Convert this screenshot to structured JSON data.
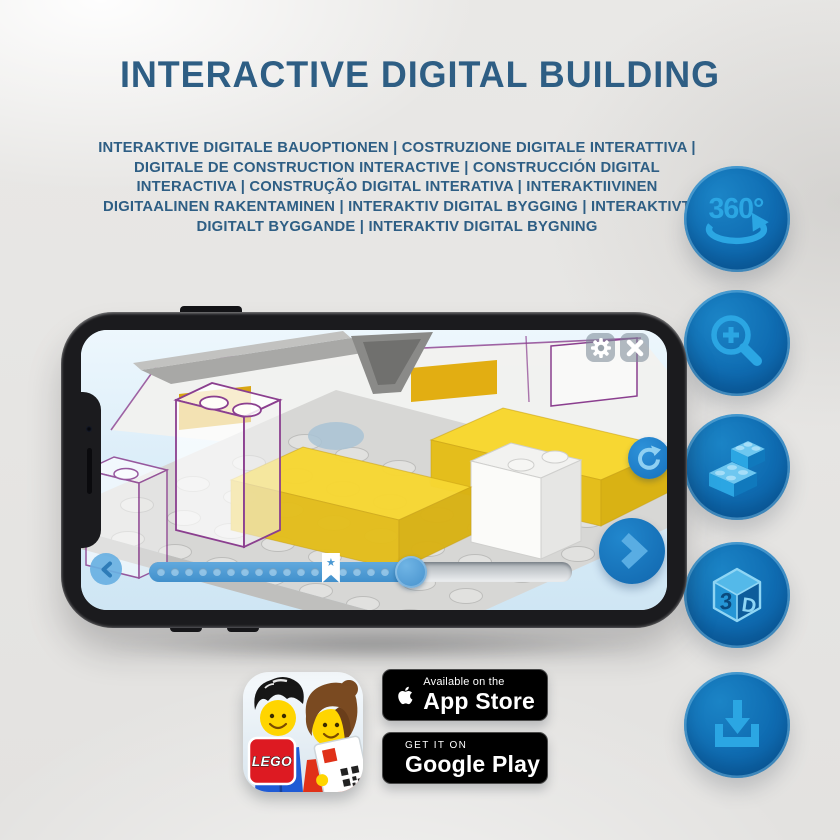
{
  "title": "INTERACTIVE DIGITAL BUILDING",
  "subtitle": "INTERAKTIVE DIGITALE BAUOPTIONEN | COSTRUZIONE DIGITALE INTERATTIVA | DIGITALE DE CONSTRUCTION INTERACTIVE | CONSTRUCCIÓN DIGITAL INTERACTIVA | CONSTRUÇÃO DIGITAL INTERATIVA | INTERAKTIIVINEN DIGITAALINEN RAKENTAMINEN | INTERAKTIV DIGITAL BYGGING | INTERAKTIVT DIGITALT BYGGANDE | INTERAKTIV DIGITAL BYGNING",
  "feature_buttons": [
    {
      "name": "rotate-360",
      "icon": "360-rotate-icon",
      "label": "360°"
    },
    {
      "name": "zoom-in",
      "icon": "zoom-in-magnifier-icon"
    },
    {
      "name": "brick-building",
      "icon": "lego-bricks-icon"
    },
    {
      "name": "view-3d",
      "icon": "3d-cube-icon",
      "cube_left": "3",
      "cube_right": "D"
    },
    {
      "name": "download",
      "icon": "download-icon"
    }
  ],
  "phone": {
    "screen": {
      "settings_icon": "gear-icon",
      "close_icon": "close-icon",
      "rotate_icon": "rotate-arrow-icon",
      "prev_icon": "chevron-left-icon",
      "next_icon": "chevron-right-icon",
      "progress": {
        "percent": 62,
        "bookmark_percent": 43,
        "dots": 19,
        "star": "★"
      }
    }
  },
  "app_icon": {
    "logo_text": "LEGO"
  },
  "badges": {
    "app_store": {
      "line1": "Available on the",
      "line2": "App Store",
      "icon": "apple-icon"
    },
    "google_play": {
      "line1": "GET IT ON",
      "line2": "Google Play",
      "icon": "google-play-icon"
    }
  },
  "colors": {
    "title_blue": "#2e5e84",
    "circle_blue": "#0f6cb2",
    "icon_light_blue": "#2ba6e3",
    "lego_yellow": "#f5d02c",
    "outline_purple": "#8b3f8f"
  }
}
